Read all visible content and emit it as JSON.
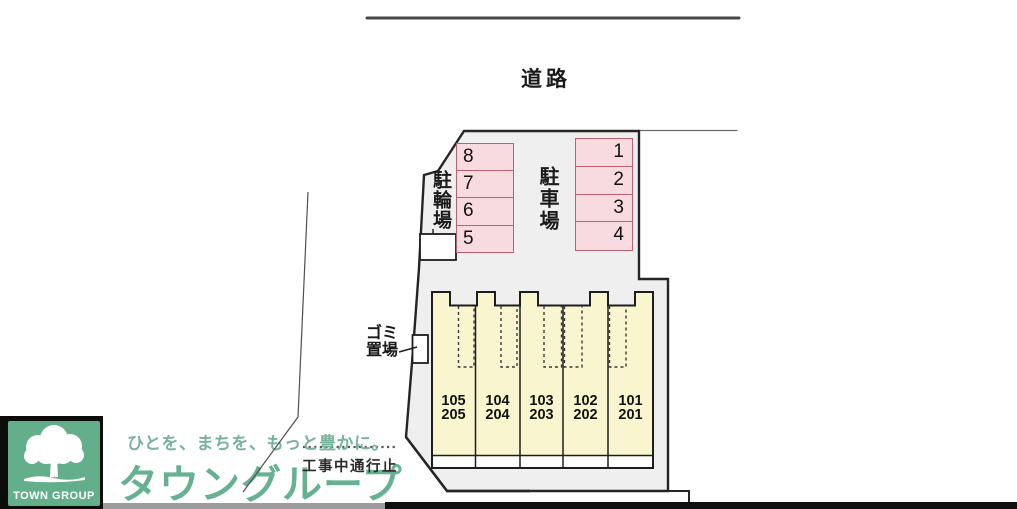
{
  "road_label": "道路",
  "site": {
    "parking_label": "駐車場",
    "bicycle_label": "駐輪場",
    "garbage_label_line1": "ゴミ",
    "garbage_label_line2": "置場",
    "stalls_left": [
      "8",
      "7",
      "6",
      "5"
    ],
    "stalls_right": [
      "1",
      "2",
      "3",
      "4"
    ],
    "units": [
      {
        "upper": "105",
        "lower": "205"
      },
      {
        "upper": "104",
        "lower": "204"
      },
      {
        "upper": "103",
        "lower": "203"
      },
      {
        "upper": "102",
        "lower": "202"
      },
      {
        "upper": "101",
        "lower": "201"
      }
    ]
  },
  "footer": {
    "logo_text": "TOWN GROUP",
    "tagline": "ひとを、まちを、もっと豊かに。",
    "brand": "タウングループ",
    "notice": "工事中通行止"
  },
  "colors": {
    "site_fill": "#efefef",
    "stall_fill": "#f8dbe1",
    "stall_border": "#bf6070",
    "building_fill": "#f8f5cf",
    "brand_green": "#67b193",
    "logo_green": "#63ae8b",
    "bar_gray": "#9c9c9c",
    "bar_black": "#0f0f0f"
  }
}
